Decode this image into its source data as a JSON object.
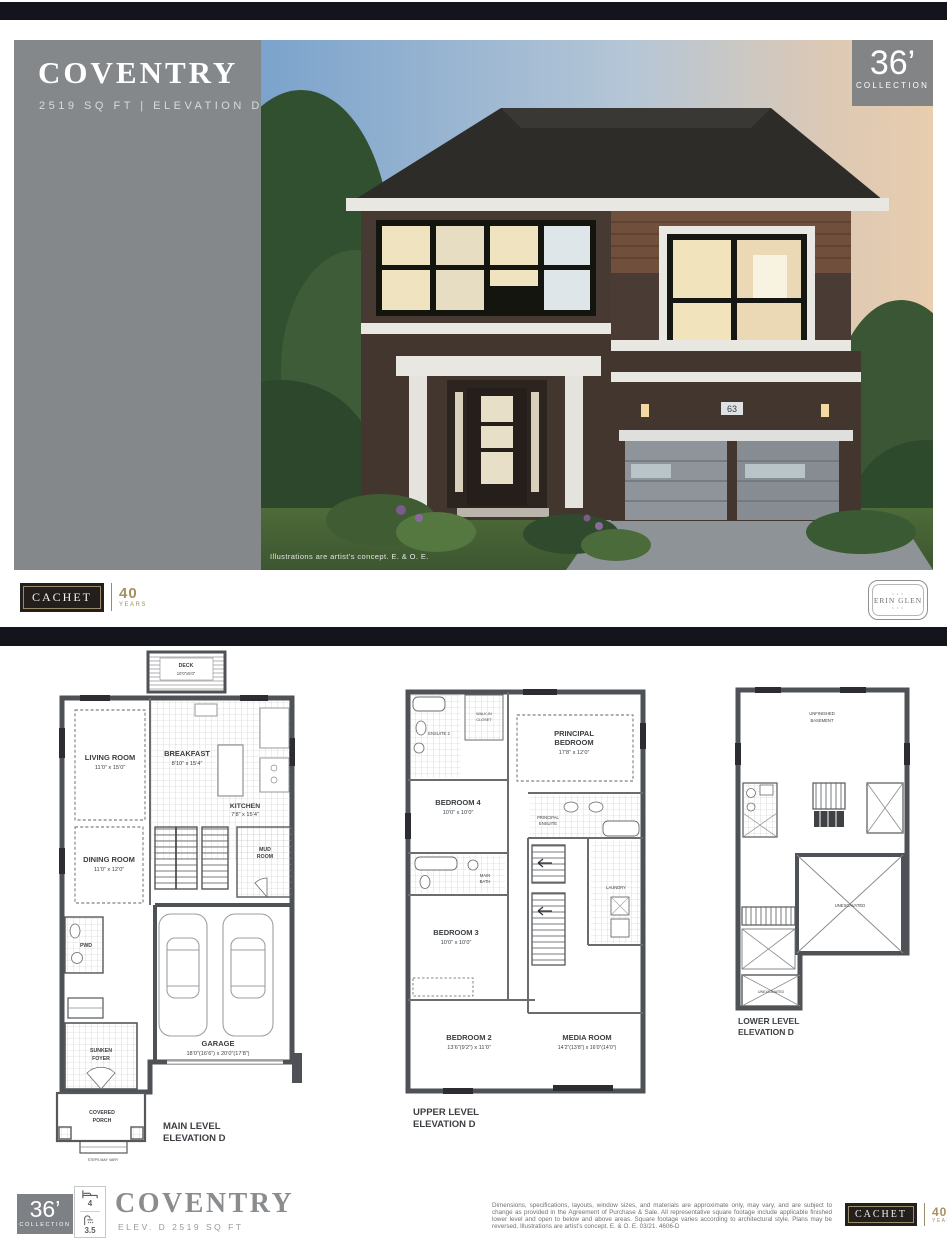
{
  "hero": {
    "model_name": "COVENTRY",
    "subtitle": "2519 SQ FT   |   ELEVATION D",
    "caption": "Illustrations are artist’s concept. E. & O. E.",
    "house_number": "63",
    "badge": {
      "size": "36’",
      "collection": "COLLECTION"
    }
  },
  "brand": {
    "name": "CACHET",
    "years_value": "40",
    "years_label": "YEARS",
    "community_name": "ERIN GLEN",
    "community_ornament": "• • •"
  },
  "plans": {
    "main": {
      "label1": "MAIN LEVEL",
      "label2": "ELEVATION D",
      "deck_name": "DECK",
      "deck_dims": "10’0”x5’0”",
      "living_name": "LIVING ROOM",
      "living_dims": "11’0” x 15’0”",
      "breakfast_name": "BREAKFAST",
      "breakfast_dims": "8’10” x 15’4”",
      "kitchen_name": "KITCHEN",
      "kitchen_dims": "7’8” x 15’4”",
      "dining_name": "DINING ROOM",
      "dining_dims": "11’0” x 12’0”",
      "mud1": "MUD",
      "mud2": "ROOM",
      "pwd": "PWD",
      "garage_name": "GARAGE",
      "garage_dims": "18’0”(16’6”) x 20’0”(17’8”)",
      "foyer1": "SUNKEN",
      "foyer2": "FOYER",
      "porch1": "COVERED",
      "porch2": "PORCH",
      "steps_note": "STEPS MAY VARY"
    },
    "upper": {
      "label1": "UPPER LEVEL",
      "label2": "ELEVATION D",
      "principal1": "PRINCIPAL",
      "principal2": "BEDROOM",
      "principal_dims": "17’8” x 12’0”",
      "ensuite2": "ENSUITE 2",
      "wic1": "WALK-IN",
      "wic2": "CLOSET",
      "bed4_name": "BEDROOM 4",
      "bed4_dims": "10’0” x 10’0”",
      "pens1": "PRINCIPAL",
      "pens2": "ENSUITE",
      "bath1": "MAIN",
      "bath2": "BATH",
      "bed3_name": "BEDROOM 3",
      "bed3_dims": "10’0” x 10’0”",
      "laundry": "LAUNDRY",
      "bed2_name": "BEDROOM 2",
      "bed2_dims": "13’6”(9’2”) x 11’0”",
      "media_name": "MEDIA ROOM",
      "media_dims": "14’2”(13’8”) x 16’0”(14’0”)"
    },
    "lower": {
      "label1": "LOWER LEVEL",
      "label2": "ELEVATION D",
      "basement1": "UNFINISHED",
      "basement2": "BASEMENT",
      "unex1": "UNEXCAVATED",
      "unex2": "UNEXCAVATED"
    }
  },
  "footer": {
    "badge_size": "36’",
    "badge_collection": "COLLECTION",
    "beds": "4",
    "baths": "3.5",
    "model_name": "COVENTRY",
    "model_sub": "ELEV. D 2519 SQ FT",
    "disclaimer": "Dimensions, specifications, layouts, window sizes, and materials are approximate only, may vary, and are subject to change as provided in the Agreement of Purchase & Sale. All representative square footage include applicable finished lower level and open to below and above areas. Square footage varies according to architectural style. Plans may be reversed. Illustrations are artist’s concept. E. & O. E. 03/21. 4606-D"
  }
}
